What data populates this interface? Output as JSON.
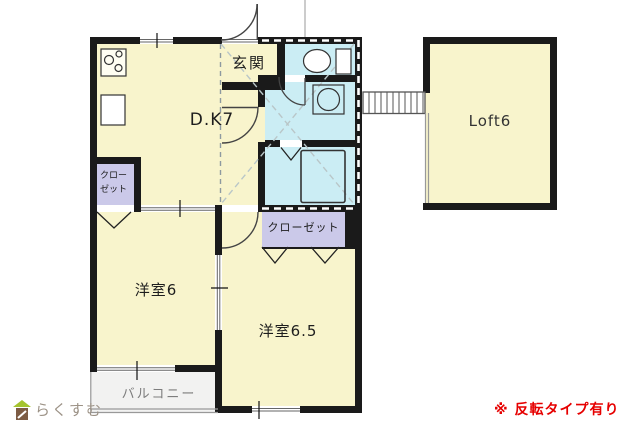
{
  "plan": {
    "rooms": {
      "dk": {
        "label": "D.K7"
      },
      "entrance": {
        "label": "玄関"
      },
      "closet_dk": {
        "label": "クローゼット"
      },
      "bedroom1": {
        "label": "洋室6"
      },
      "bedroom2": {
        "label": "洋室6.5"
      },
      "closet_bedroom2": {
        "label": "クローゼット"
      },
      "balcony": {
        "label": "バルコニー"
      },
      "loft": {
        "label": "Loft6"
      }
    },
    "colors": {
      "floor": "#F8F4CC",
      "wet_area": "#CBEDF4",
      "closet": "#CBC9E9",
      "balcony": "#F2F2F1",
      "wall": "#1A1A1A",
      "loft_outline_dash": "#8E9AA0"
    }
  },
  "footer": {
    "brand": "らくすむ",
    "brand_colors": {
      "roof": "#A5C42F",
      "body": "#7D5C44"
    },
    "note": "※ 反転タイプ有り",
    "note_color": "#E60000"
  }
}
